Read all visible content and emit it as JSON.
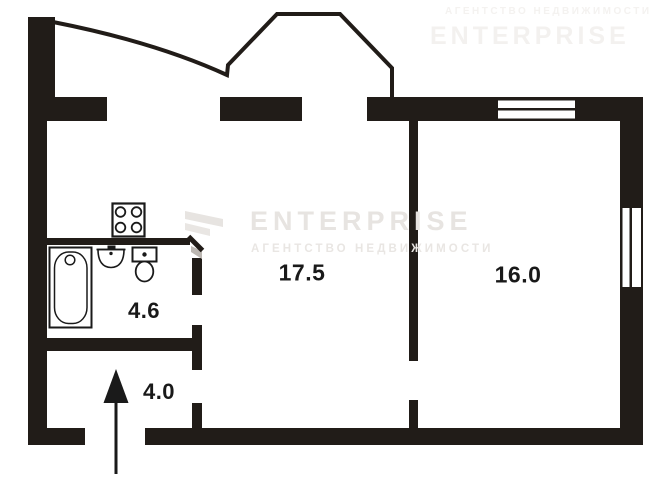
{
  "plan": {
    "rooms": [
      {
        "area_label": "17.5"
      },
      {
        "area_label": "16.0"
      },
      {
        "area_label": "4.6"
      },
      {
        "area_label": "4.0"
      }
    ],
    "fixtures": [
      "stove-icon",
      "bathtub-icon",
      "sink-icon",
      "toilet-icon",
      "entrance-arrow-icon",
      "door-swing-icon",
      "top-wall-window",
      "right-wall-window",
      "balcony-outline"
    ],
    "colors": {
      "wall": "#211c18",
      "background": "#ffffff",
      "label": "#191919",
      "watermark": "#e7e4e1",
      "door_shadow": "#bcb7b2"
    }
  },
  "watermark": {
    "brand": "ENTERPRISE",
    "subtitle": "АГЕНТСТВО НЕДВИЖИМОСТИ"
  }
}
